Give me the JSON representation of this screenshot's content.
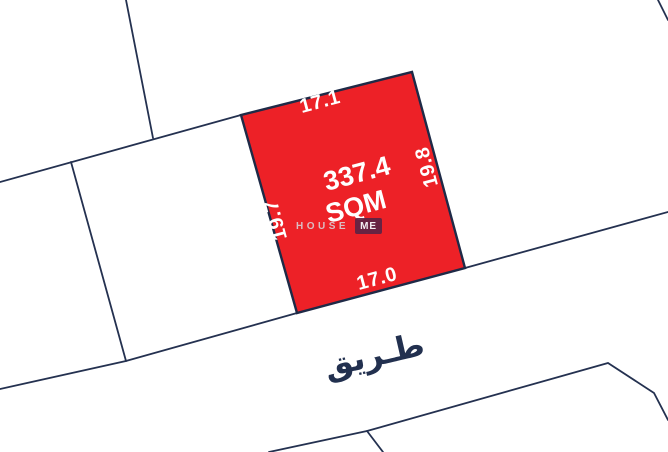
{
  "map": {
    "highlighted_plot": {
      "area_value": "337.4",
      "area_unit": "SQM",
      "dimensions": {
        "top": "17.1",
        "right": "19.8",
        "bottom": "17.0",
        "left": "19.7"
      }
    },
    "road_label": "طـريق"
  },
  "watermark": {
    "word_primary": "HOUSE",
    "word_badge": "ME"
  },
  "colors": {
    "plot_fill": "#ED2127",
    "boundary_line": "#243150",
    "plot_text": "#FFFFFF",
    "road_text": "#22304F",
    "watermark_text": "#D6D8DE",
    "watermark_badge": "#5B2444",
    "background": "#FFFFFF"
  }
}
